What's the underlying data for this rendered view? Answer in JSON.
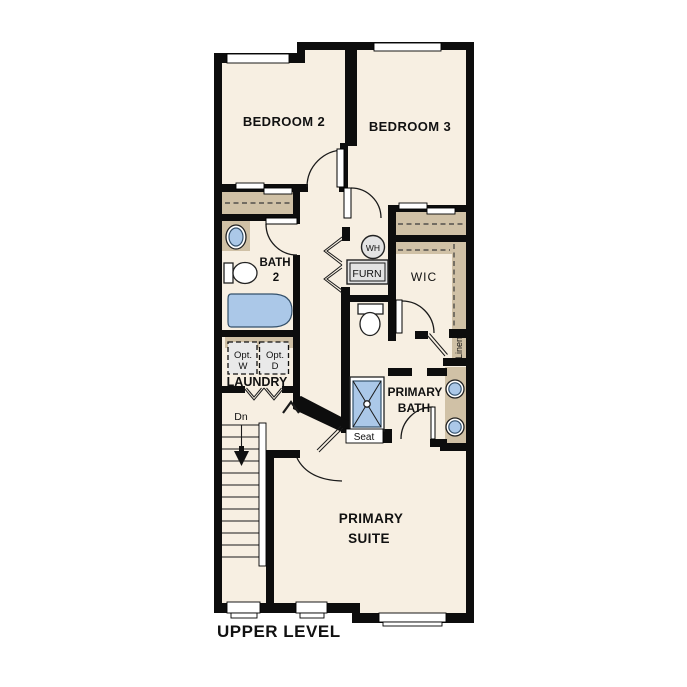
{
  "title": "UPPER LEVEL",
  "colors": {
    "floor": "#f7efe2",
    "wall": "#0d0d0d",
    "closet_tan": "#d0c1a6",
    "fixture_blue": "#abc8e8",
    "fixture_gray": "#e3e3e3",
    "background": "#ffffff"
  },
  "rooms": {
    "bedroom2": {
      "label": "BEDROOM 2"
    },
    "bedroom3": {
      "label": "BEDROOM 3"
    },
    "bath2": {
      "label_line1": "BATH",
      "label_line2": "2"
    },
    "wic": {
      "label": "WIC"
    },
    "linen": {
      "label": "Linen"
    },
    "laundry": {
      "label": "LAUNDRY",
      "washer_line1": "Opt.",
      "washer_line2": "W",
      "dryer_line1": "Opt.",
      "dryer_line2": "D"
    },
    "utility": {
      "water_heater_label": "WH",
      "furnace_label": "FURN"
    },
    "primary_bath": {
      "label_line1": "PRIMARY",
      "label_line2": "BATH",
      "seat_label": "Seat"
    },
    "primary_suite": {
      "label_line1": "PRIMARY",
      "label_line2": "SUITE"
    },
    "stairs": {
      "down_label": "Dn"
    }
  }
}
